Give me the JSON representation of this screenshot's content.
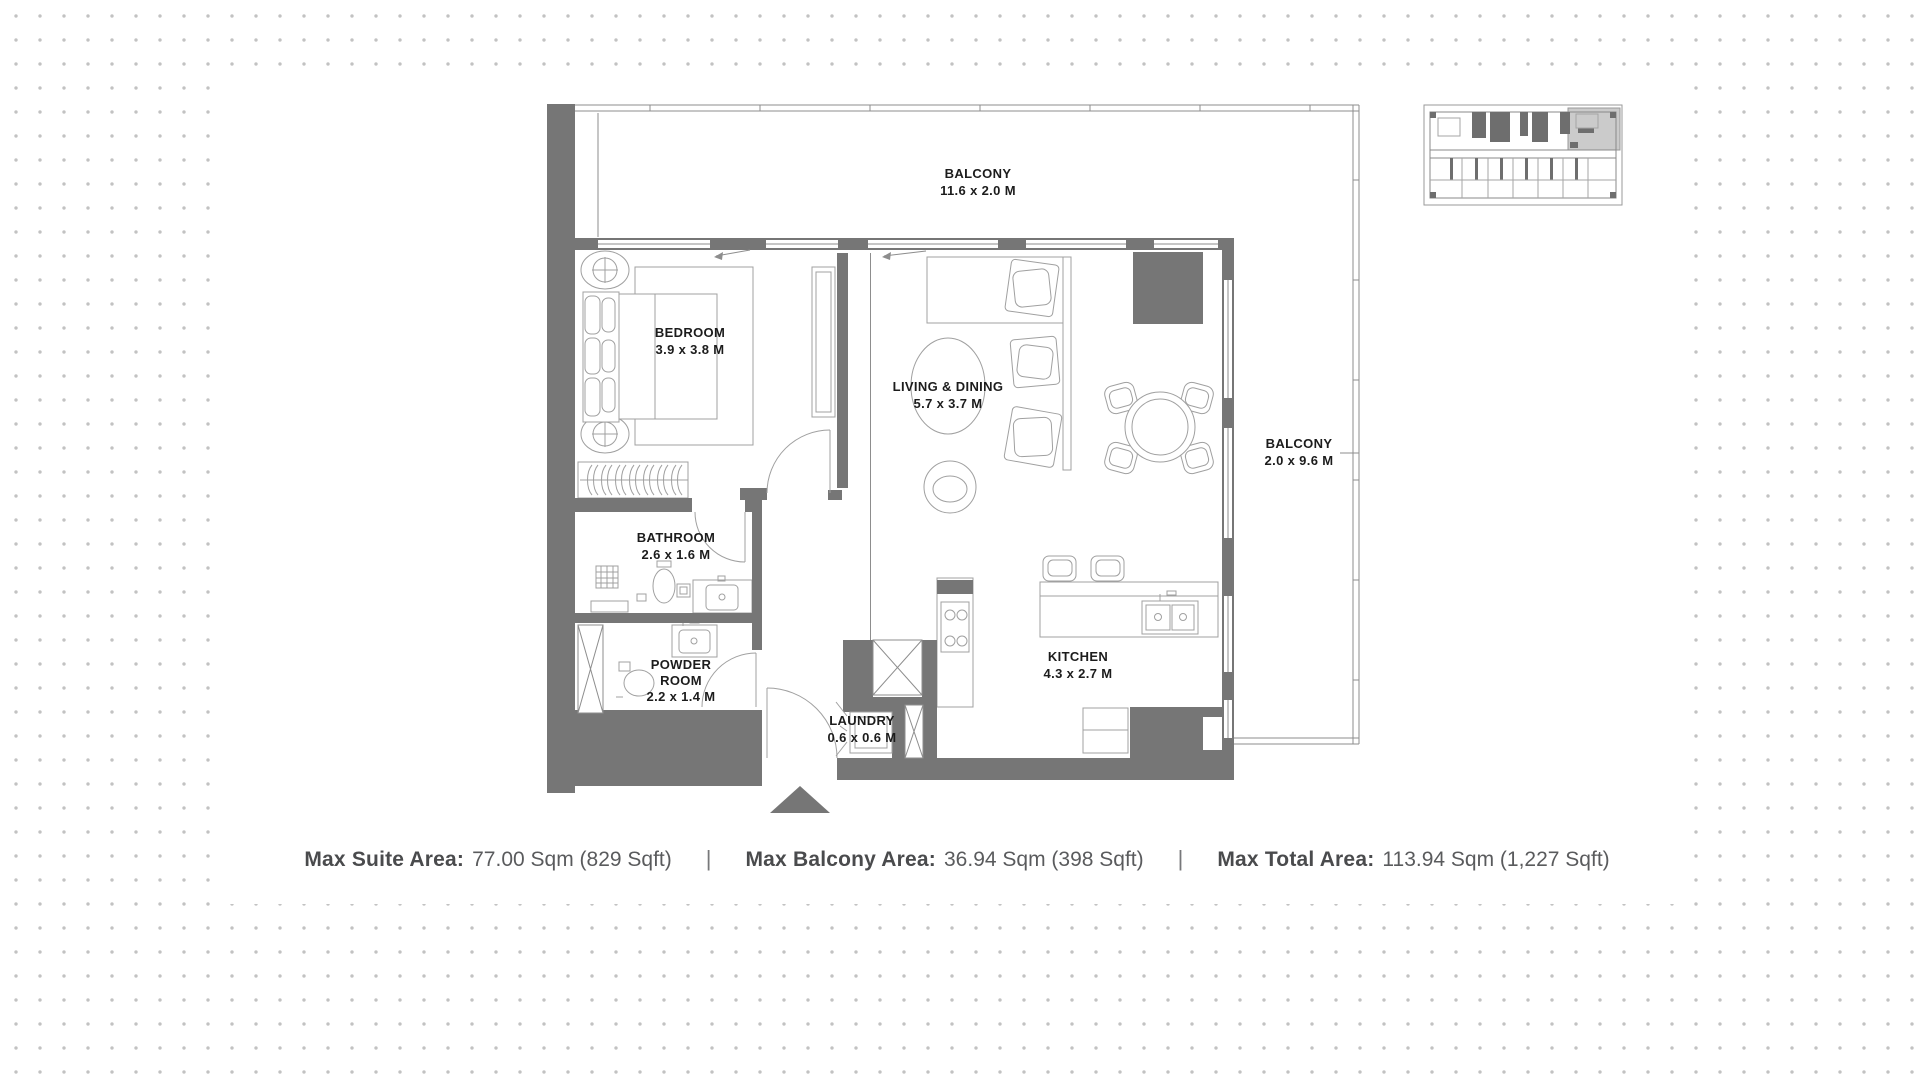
{
  "floor_plan": {
    "rooms": [
      {
        "id": "balcony-top",
        "name": "BALCONY",
        "dims": "11.6 x 2.0 M"
      },
      {
        "id": "bedroom",
        "name": "BEDROOM",
        "dims": "3.9 x 3.8 M"
      },
      {
        "id": "living-dining",
        "name": "LIVING & DINING",
        "dims": "5.7 x 3.7 M"
      },
      {
        "id": "balcony-right",
        "name": "BALCONY",
        "dims": "2.0 x 9.6 M"
      },
      {
        "id": "bathroom",
        "name": "BATHROOM",
        "dims": "2.6 x 1.6 M"
      },
      {
        "id": "powder-room",
        "name": "POWDER ROOM",
        "dims": "2.2 x 1.4 M"
      },
      {
        "id": "laundry",
        "name": "LAUNDRY",
        "dims": "0.6 x 0.6 M"
      },
      {
        "id": "kitchen",
        "name": "KITCHEN",
        "dims": "4.3 x 2.7 M"
      }
    ]
  },
  "stats": {
    "separator": "|",
    "items": [
      {
        "label": "Max Suite Area:",
        "value": "77.00 Sqm (829 Sqft)"
      },
      {
        "label": "Max Balcony Area:",
        "value": "36.94 Sqm (398 Sqft)"
      },
      {
        "label": "Max Total Area:",
        "value": "113.94 Sqm (1,227 Sqft)"
      }
    ]
  },
  "colors": {
    "wall": "#767676",
    "line": "#8d8d8d",
    "furn": "#a0a0a0",
    "dot": "#c2c2c2",
    "highlight": "#cbcbcb",
    "label": "#1c1c1c",
    "statslabel": "#4a4b4d",
    "statsvalue": "#5a5b5d"
  }
}
